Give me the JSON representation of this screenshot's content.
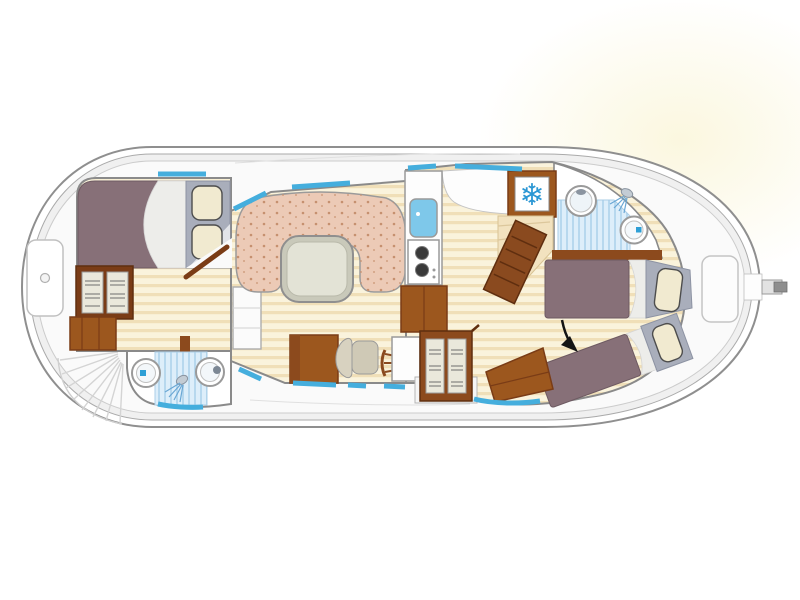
{
  "floorplan": {
    "kind": "boat-floor-plan",
    "icons": {
      "freezer_snowflake": "❄"
    },
    "fixtures": [
      "bow-locker",
      "bow-steps",
      "double-bed",
      "wardrobe-forward",
      "forward-cabin-door",
      "toilet-forward",
      "shower-forward",
      "washbasin-forward",
      "dinette-sofa",
      "dinette-table",
      "saloon-cabinet",
      "galley-sink",
      "stove",
      "galley-cabinet",
      "galley-counter",
      "freezer",
      "companionway-stairs",
      "helm-console",
      "helm-seat",
      "steering-wheel",
      "instrument-panel",
      "wardrobe-central",
      "washbasin-aft",
      "shower-aft",
      "toilet-aft",
      "single-bed-aft-1",
      "single-bed-aft-2",
      "aft-cabinet",
      "entry-arrow",
      "stern-seat",
      "rudder-tiller",
      "windows"
    ],
    "colors": {
      "hull_line": "#8f8f8f",
      "hull_band": "#f0f0f0",
      "deck": "#fafafa",
      "wall_line": "#8a8a8a",
      "wood_light": "#faf3dc",
      "wood_dark": "#f0dfb8",
      "sofa_pink": "#eccab6",
      "sofa_dot": "#c6906f",
      "table_top": "#e3e3d6",
      "table_rim": "#c9c9ba",
      "bed_purple": "#877078",
      "sheet_white": "#ededea",
      "headboard_gray": "#a9aebb",
      "pillow_cream": "#f1ead0",
      "furniture_brown": "#9c571e",
      "furniture_brown_dark": "#7a3c16",
      "stair_brown": "#8a4a1f",
      "door_panel_cream": "#eae8db",
      "window_blue": "#45aedd",
      "shower_bg": "#ddeefa",
      "shower_stripe": "#b7d8ee",
      "water_blue": "#2d9fd6",
      "snowflake_blue": "#2b97d4",
      "galley_sink_blue": "#7ec8ea",
      "stove_burner": "#3a3a3a",
      "arrow_black": "#141414",
      "glow_cream": "#fbf7df"
    }
  }
}
